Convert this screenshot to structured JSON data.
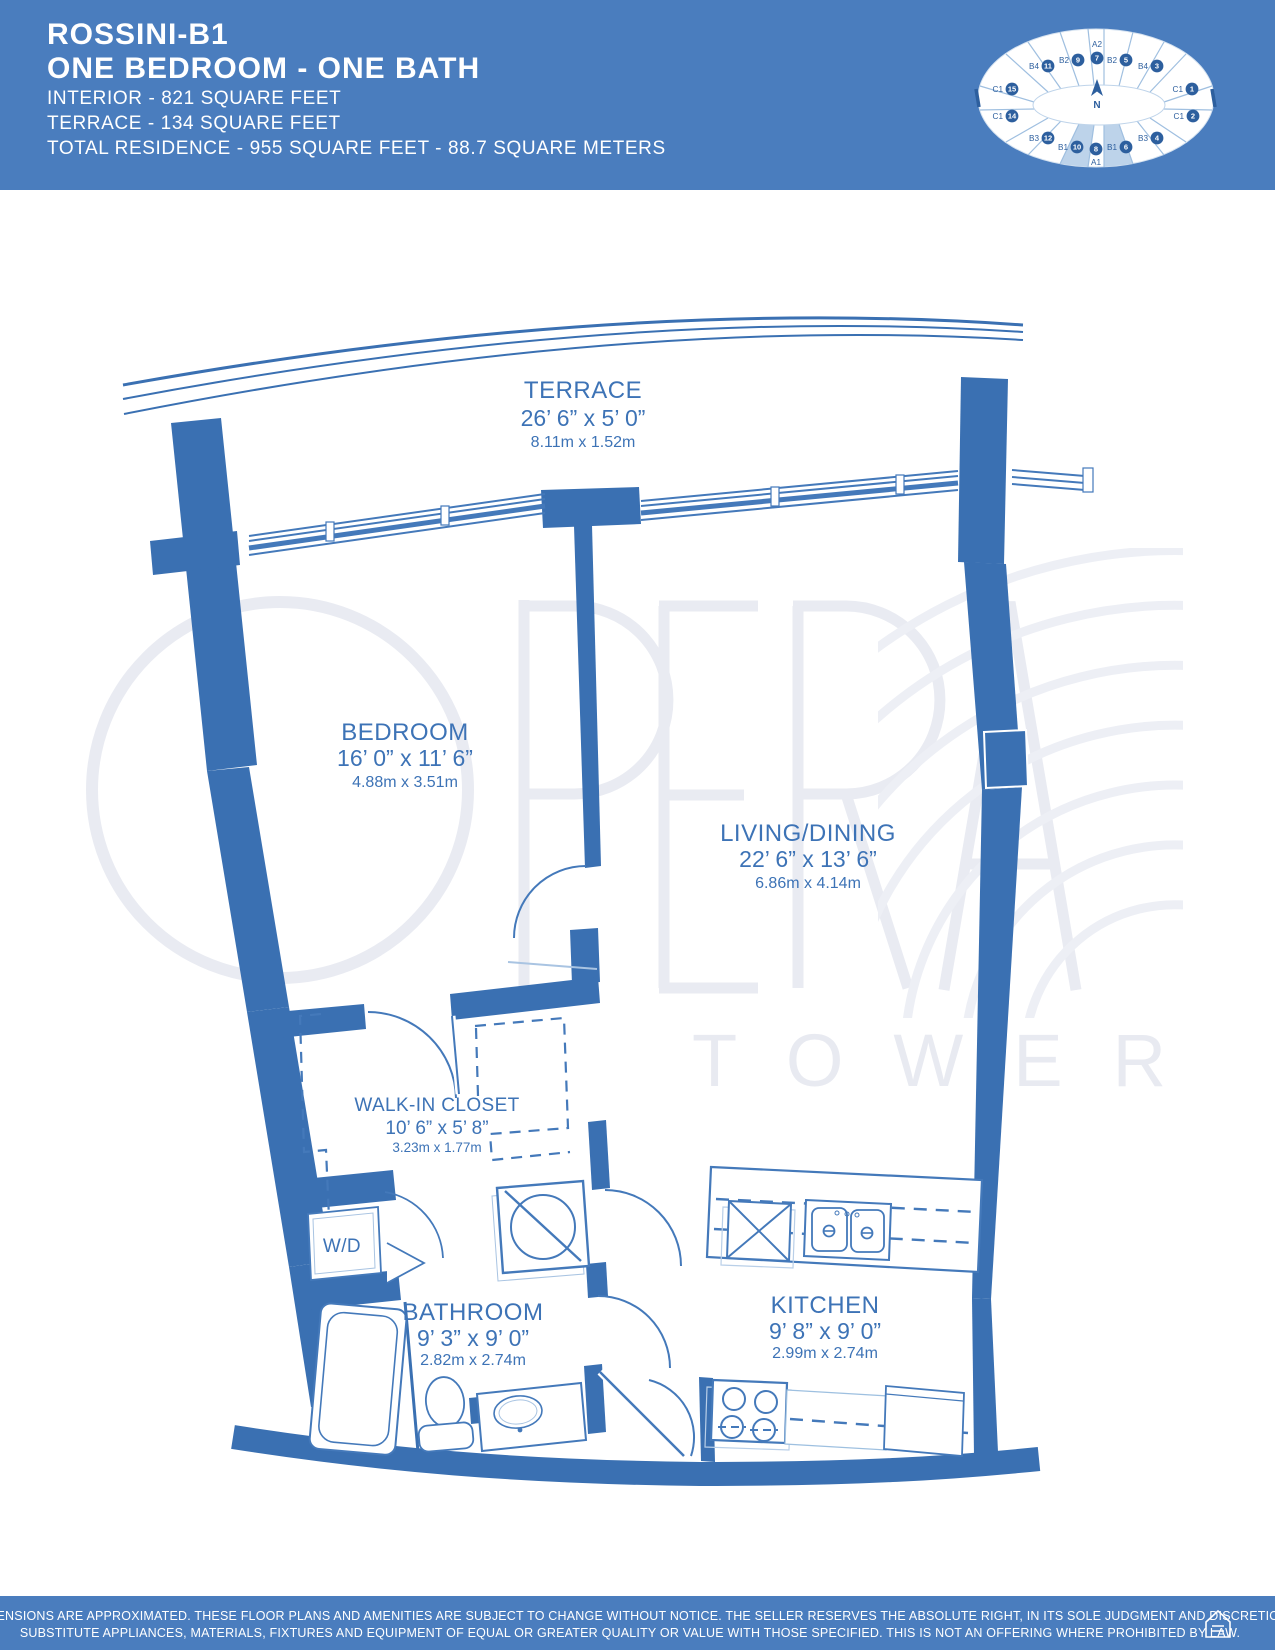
{
  "header": {
    "plan_name": "ROSSINI-B1",
    "plan_subtitle": "ONE BEDROOM - ONE BATH",
    "stats": [
      "INTERIOR - 821 SQUARE FEET",
      "TERRACE - 134 SQUARE FEET",
      "TOTAL RESIDENCE - 955 SQUARE FEET - 88.7 SQUARE METERS"
    ]
  },
  "key_plan": {
    "north_label": "N",
    "highlighted_unit_type": "B1",
    "highlighted_numbers": [
      "10",
      "6"
    ],
    "units": [
      {
        "type": "B4",
        "number": "11"
      },
      {
        "type": "B2",
        "number": "9"
      },
      {
        "type": "A2",
        "number": "7"
      },
      {
        "type": "B2",
        "number": "5"
      },
      {
        "type": "B4",
        "number": "3"
      },
      {
        "type": "C1",
        "number": "1"
      },
      {
        "type": "C1",
        "number": "2"
      },
      {
        "type": "B3",
        "number": "4"
      },
      {
        "type": "B1",
        "number": "6"
      },
      {
        "type": "A1",
        "number": "8"
      },
      {
        "type": "B1",
        "number": "10"
      },
      {
        "type": "B3",
        "number": "12"
      },
      {
        "type": "C1",
        "number": "14"
      },
      {
        "type": "C1",
        "number": "15"
      }
    ]
  },
  "watermark": {
    "line1": "OPERA",
    "line2": "TOWER"
  },
  "rooms": [
    {
      "id": "terrace",
      "name": "TERRACE",
      "imperial": "26’ 6” x 5’ 0”",
      "metric": "8.11m x 1.52m"
    },
    {
      "id": "bedroom",
      "name": "BEDROOM",
      "imperial": "16’ 0” x 11’ 6”",
      "metric": "4.88m x 3.51m"
    },
    {
      "id": "living",
      "name": "LIVING/DINING",
      "imperial": "22’ 6” x 13’ 6”",
      "metric": "6.86m x 4.14m"
    },
    {
      "id": "closet",
      "name": "WALK-IN CLOSET",
      "imperial": "10’ 6” x 5’ 8”",
      "metric": "3.23m x 1.77m"
    },
    {
      "id": "bathroom",
      "name": "BATHROOM",
      "imperial": "9’ 3” x 9’ 0”",
      "metric": "2.82m x 2.74m"
    },
    {
      "id": "kitchen",
      "name": "KITCHEN",
      "imperial": "9’ 8” x 9’ 0”",
      "metric": "2.99m x 2.74m"
    }
  ],
  "fixtures": {
    "washer_dryer_label": "W/D"
  },
  "footer": {
    "disclaimer_line1": "ALL DIMENSIONS ARE APPROXIMATED. THESE FLOOR PLANS AND AMENITIES ARE SUBJECT TO CHANGE WITHOUT NOTICE. THE SELLER RESERVES THE ABSOLUTE RIGHT, IN ITS SOLE JUDGMENT AND DISCRETION, TO",
    "disclaimer_line2": "SUBSTITUTE APPLIANCES, MATERIALS, FIXTURES AND EQUIPMENT OF EQUAL OR GREATER QUALITY OR VALUE WITH THOSE SPECIFIED. THIS IS NOT AN OFFERING WHERE PROHIBITED BY LAW."
  },
  "colors": {
    "brand_blue": "#4a7dbe",
    "wall_blue": "#3a70b2",
    "label_blue": "#3d73b6",
    "keyplan_dark_blue": "#2d5f9e",
    "keyplan_highlight": "#bdd3ea",
    "watermark_gray": "#e9ebf2"
  }
}
